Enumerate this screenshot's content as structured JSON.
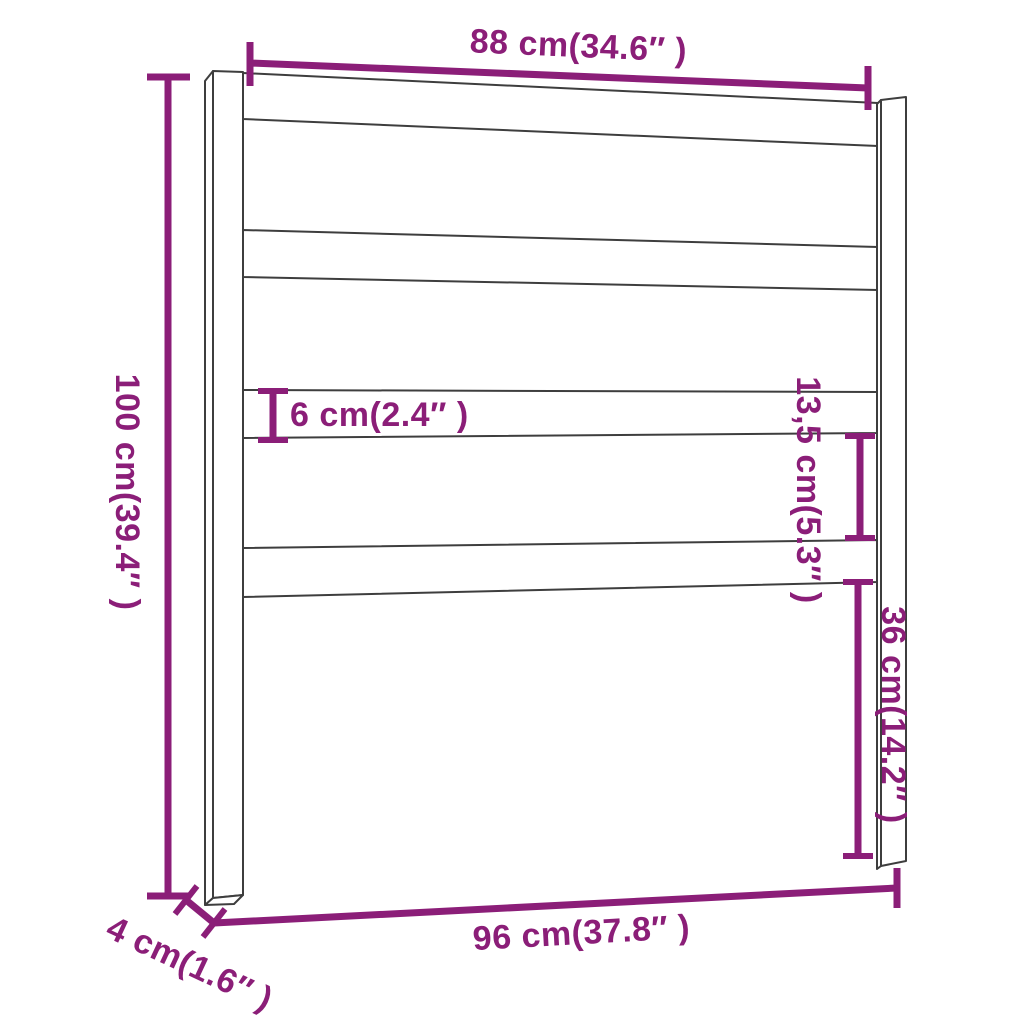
{
  "title": "Headboard dimension diagram",
  "colors": {
    "dimension_accent": "#8B1E78",
    "outline": "#3E3E3E",
    "background": "#FFFFFF"
  },
  "labels": {
    "top_width": "88 cm(34.6″ )",
    "left_height": "100 cm(39.4″ )",
    "slat_thickness": "6 cm(2.4″ )",
    "slat_gap": "13,5 cm(5.3″ )",
    "lower_gap": "36 cm(14.2″ )",
    "post_depth": "4 cm(1.6″ )",
    "bottom_width": "96 cm(37.8″ )"
  }
}
